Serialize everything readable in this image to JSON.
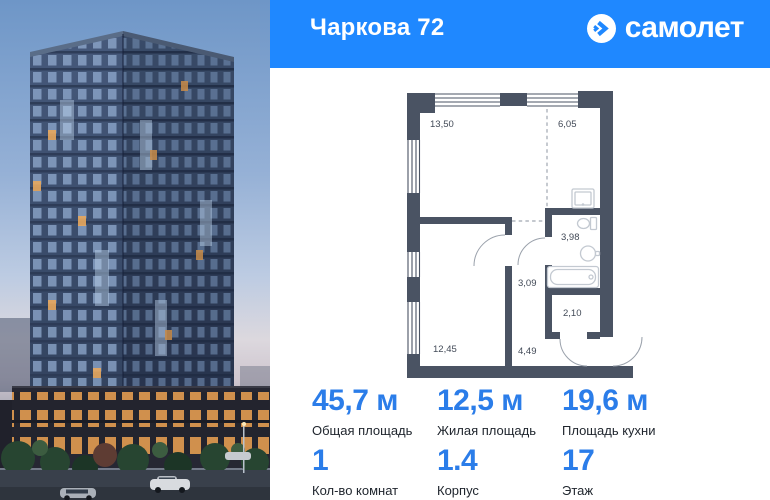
{
  "header": {
    "title": "Чаркова 72",
    "brand": "самолет",
    "brand_icon": "arrow-circle-icon",
    "bg_color": "#1f88ff"
  },
  "photo": {
    "name": "residential-tower-at-dusk"
  },
  "floor_plan": {
    "wall_color": "#4a5363",
    "rooms": [
      {
        "name": "living-room",
        "area": "13,50"
      },
      {
        "name": "kitchen",
        "area": "6,05"
      },
      {
        "name": "bathroom",
        "area": "3,98"
      },
      {
        "name": "corridor",
        "area": "3,09"
      },
      {
        "name": "storage",
        "area": "2,10"
      },
      {
        "name": "bedroom",
        "area": "12,45"
      },
      {
        "name": "hallway",
        "area": "4,49"
      }
    ],
    "fixtures": [
      "kitchen-sink",
      "toilet",
      "washbasin",
      "bathtub"
    ]
  },
  "stats": {
    "accent_color": "#2b7de9",
    "label_color": "#20262e",
    "primary": [
      {
        "value": "45,7 м",
        "label": "Общая площадь"
      },
      {
        "value": "12,5 м",
        "label": "Жилая площадь"
      },
      {
        "value": "19,6 м",
        "label": "Площадь кухни"
      }
    ],
    "secondary": [
      {
        "value": "1",
        "label": "Кол-во комнат"
      },
      {
        "value": "1.4",
        "label": "Корпус"
      },
      {
        "value": "17",
        "label": "Этаж"
      }
    ]
  }
}
